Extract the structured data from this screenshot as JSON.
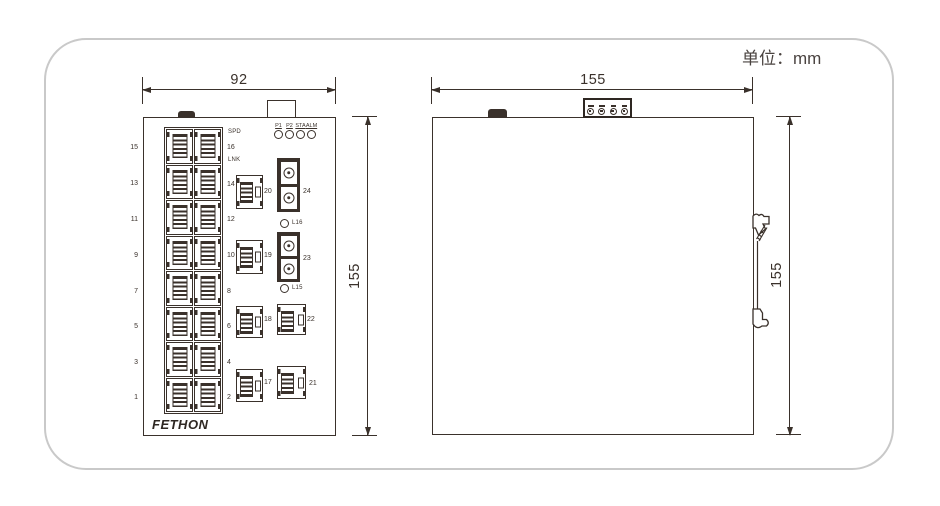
{
  "unit_label": "单位：mm",
  "front_view": {
    "width_dim": "92",
    "height_dim": "155",
    "led_labels": [
      "P1",
      "P2",
      "STA",
      "ALM"
    ],
    "spd_label": "SPD",
    "lnk_label": "LNK",
    "left_port_labels": [
      "15",
      "13",
      "11",
      "9",
      "7",
      "5",
      "3",
      "1"
    ],
    "right_port_labels": [
      "16",
      "14",
      "12",
      "10",
      "8",
      "6",
      "4",
      "2"
    ],
    "middle_port_labels": [
      "20",
      "19",
      "18",
      "17"
    ],
    "fiber_port_labels": [
      "24",
      "23"
    ],
    "fiber_led_labels": [
      "L16",
      "L15"
    ],
    "corner_port_labels": [
      "22",
      "21"
    ],
    "brand": "FETHON"
  },
  "side_view": {
    "width_dim": "155",
    "height_dim": "155"
  }
}
